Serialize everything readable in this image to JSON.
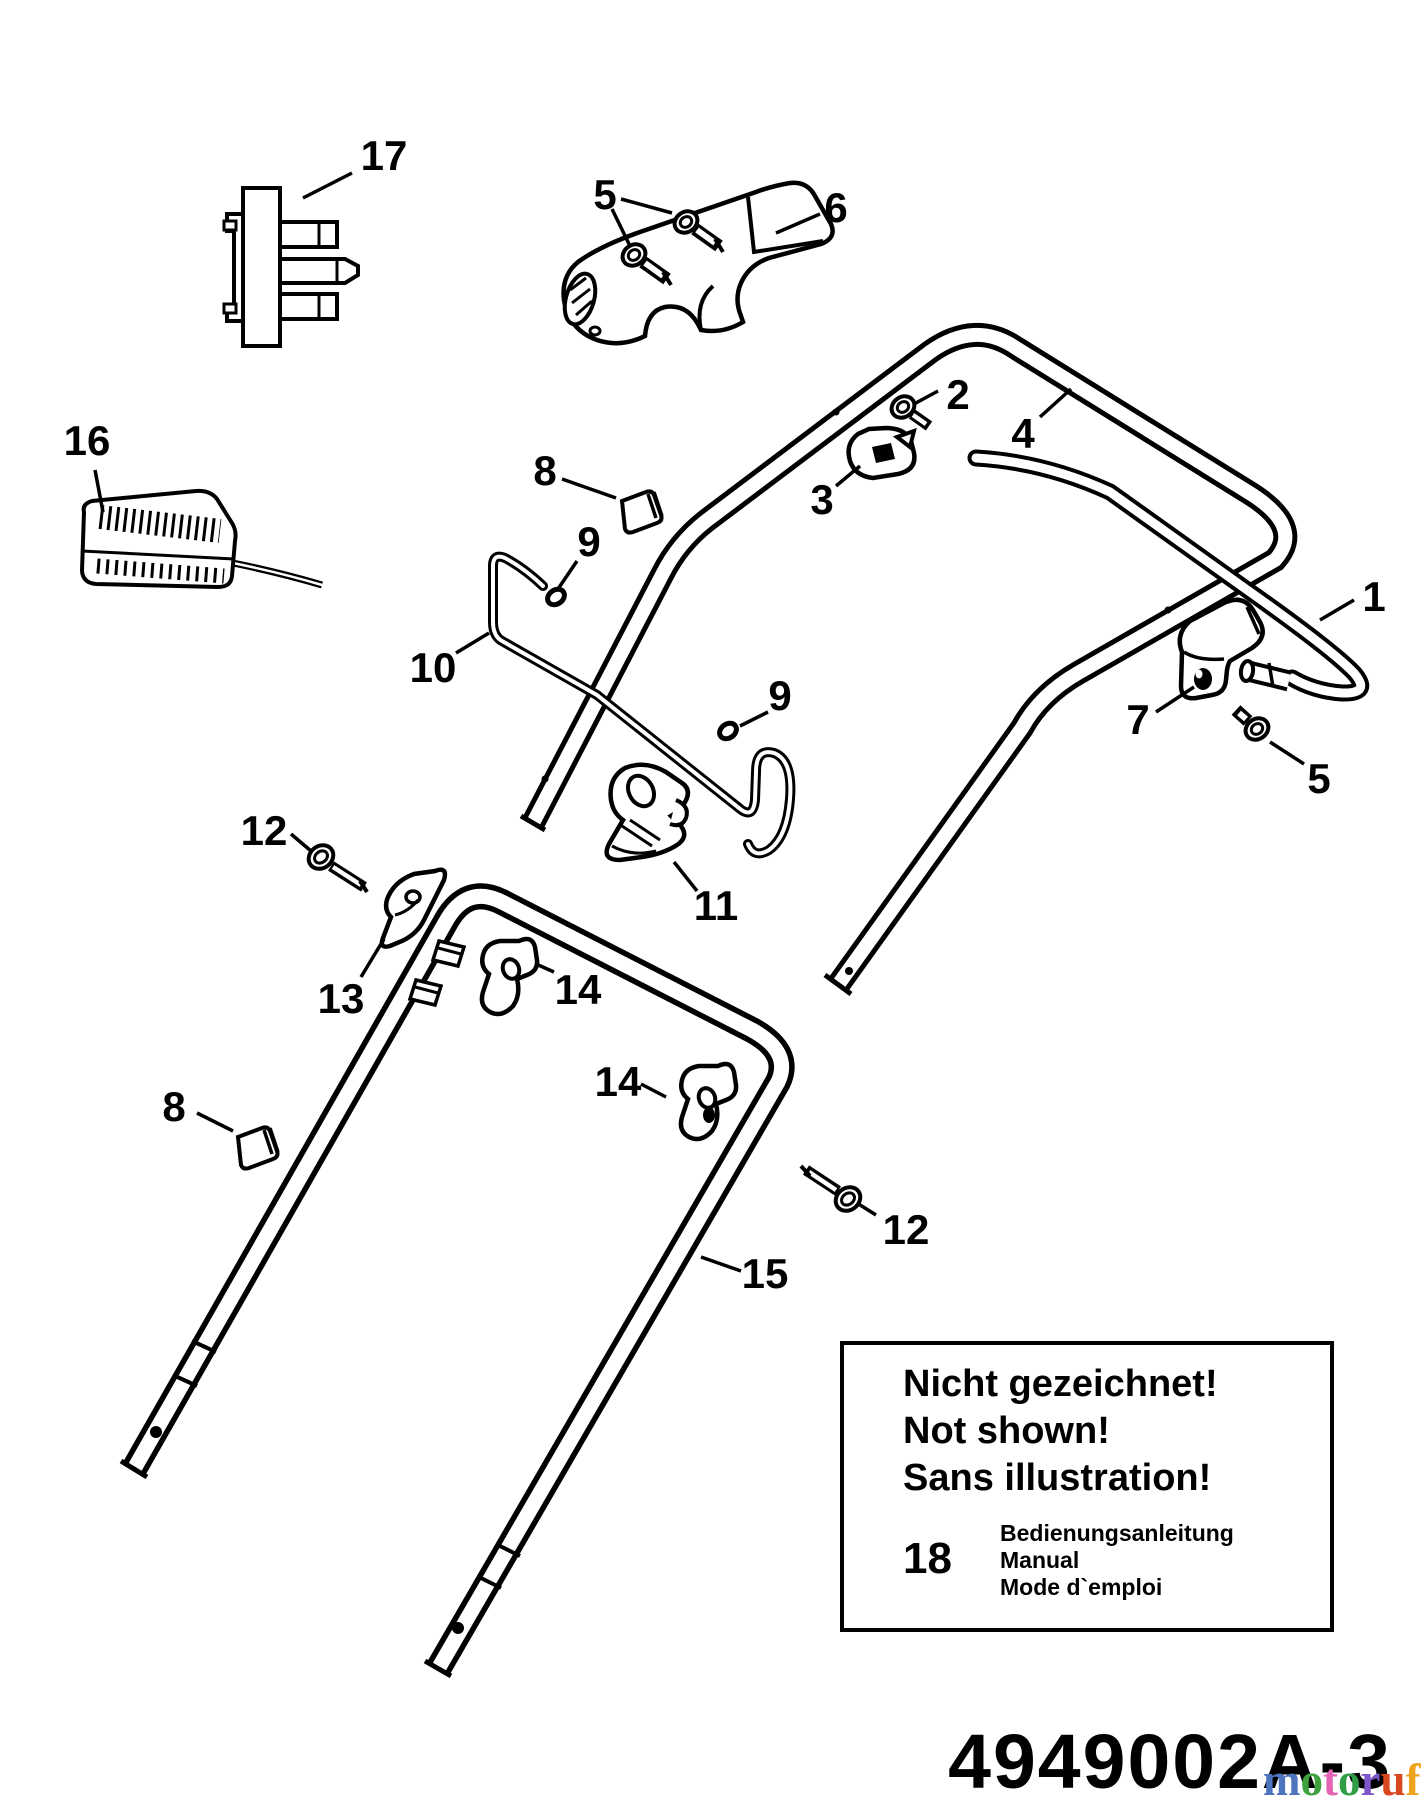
{
  "page": {
    "background": "#ffffff",
    "line_color": "#000000"
  },
  "diagram": {
    "part_number": "4949002A-3",
    "callouts": {
      "c17": "17",
      "c5top": "5",
      "c6": "6",
      "c2": "2",
      "c3": "3",
      "c4": "4",
      "c16": "16",
      "c8u": "8",
      "c9u": "9",
      "c10": "10",
      "c9l": "9",
      "c1": "1",
      "c7": "7",
      "c5r": "5",
      "c11": "11",
      "c12u": "12",
      "c13": "13",
      "c14u": "14",
      "c14l": "14",
      "c8l": "8",
      "c12l": "12",
      "c15": "15"
    }
  },
  "info_box": {
    "lines": [
      "Nicht gezeichnet!",
      "Not shown!",
      "Sans illustration!"
    ],
    "item_number": "18",
    "item_descriptions": [
      "Bedienungsanleitung",
      "Manual",
      "Mode d`emploi"
    ]
  },
  "watermark": {
    "letters": [
      {
        "ch": "m",
        "color": "#4e74bd"
      },
      {
        "ch": "o",
        "color": "#3da23d"
      },
      {
        "ch": "t",
        "color": "#e763b6"
      },
      {
        "ch": "o",
        "color": "#2f9e47"
      },
      {
        "ch": "r",
        "color": "#7e57c9"
      },
      {
        "ch": "u",
        "color": "#d8471f"
      },
      {
        "ch": "f",
        "color": "#eea41d"
      }
    ],
    "suffix": {
      "ch": ".de",
      "color": "#8f8f8f"
    }
  }
}
